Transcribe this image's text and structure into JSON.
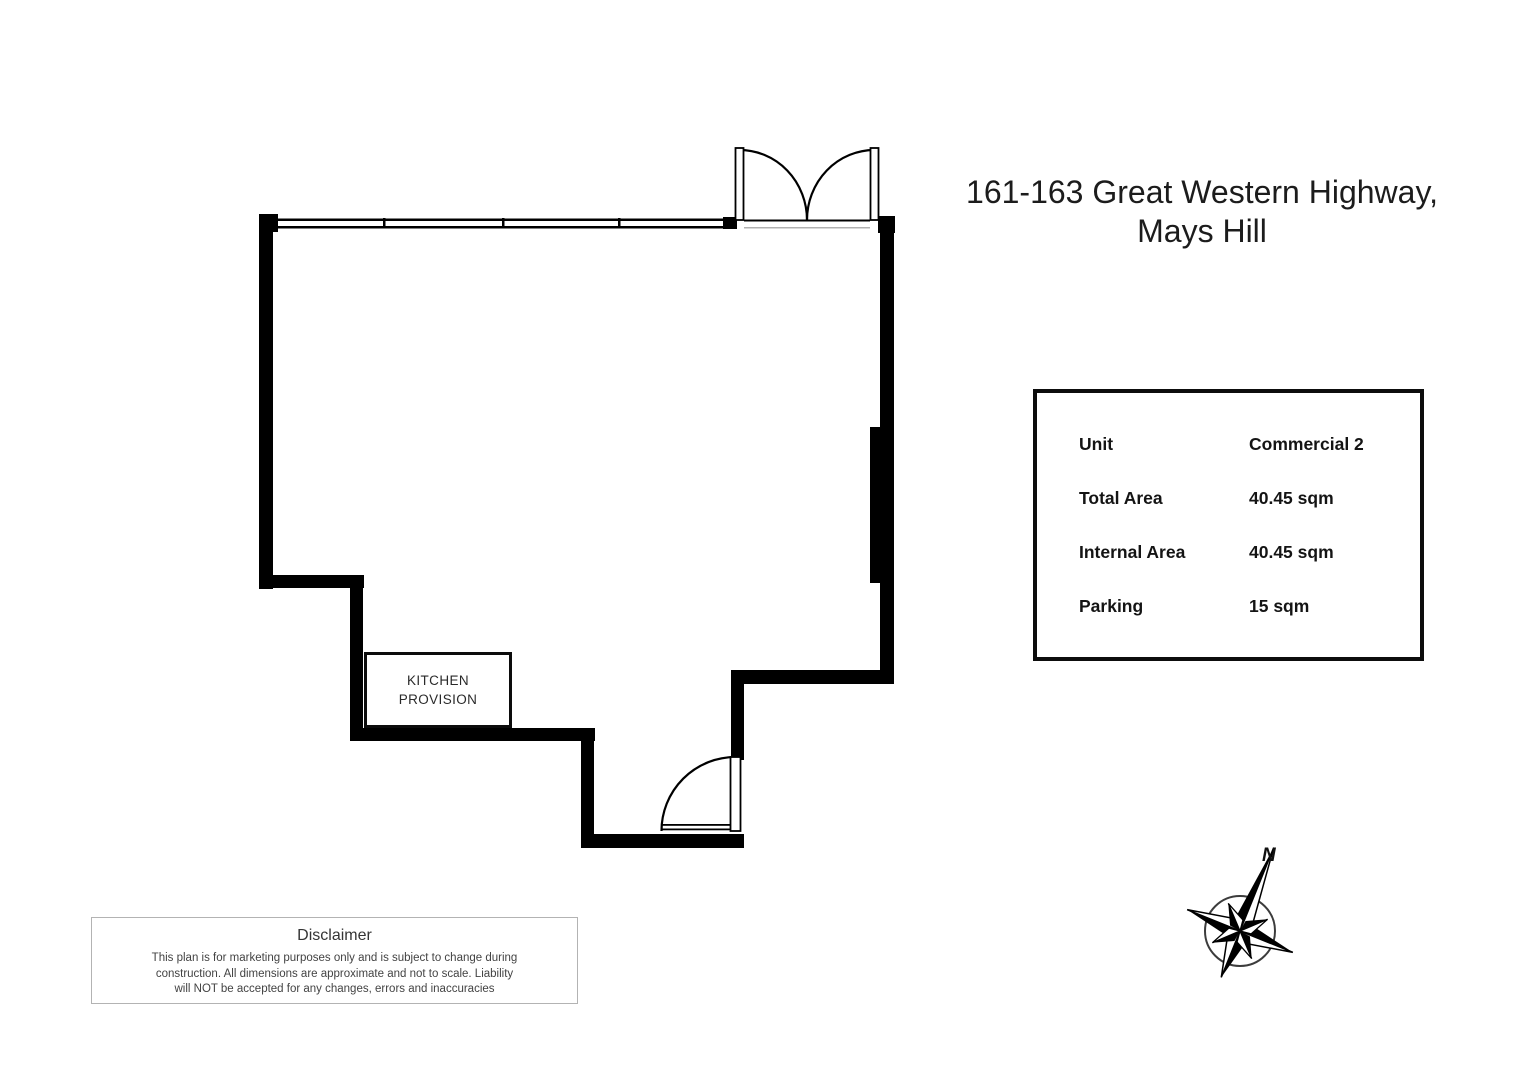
{
  "title": {
    "line1": "161-163 Great Western Highway,",
    "line2": "Mays Hill"
  },
  "info_box": {
    "rows": [
      {
        "label": "Unit",
        "value": "Commercial 2"
      },
      {
        "label": "Total Area",
        "value": "40.45 sqm"
      },
      {
        "label": "Internal Area",
        "value": "40.45 sqm"
      },
      {
        "label": "Parking",
        "value": "15 sqm"
      }
    ]
  },
  "floor_plan": {
    "kitchen_label_line1": "KITCHEN",
    "kitchen_label_line2": "PROVISION",
    "wall_color": "#000000"
  },
  "compass": {
    "north_label": "N"
  },
  "disclaimer": {
    "title": "Disclaimer",
    "lines": [
      "This plan is for marketing purposes only and is subject to change during",
      "construction. All dimensions are approximate and not to scale. Liability",
      "will NOT  be accepted for any changes, errors and inaccuracies"
    ]
  }
}
